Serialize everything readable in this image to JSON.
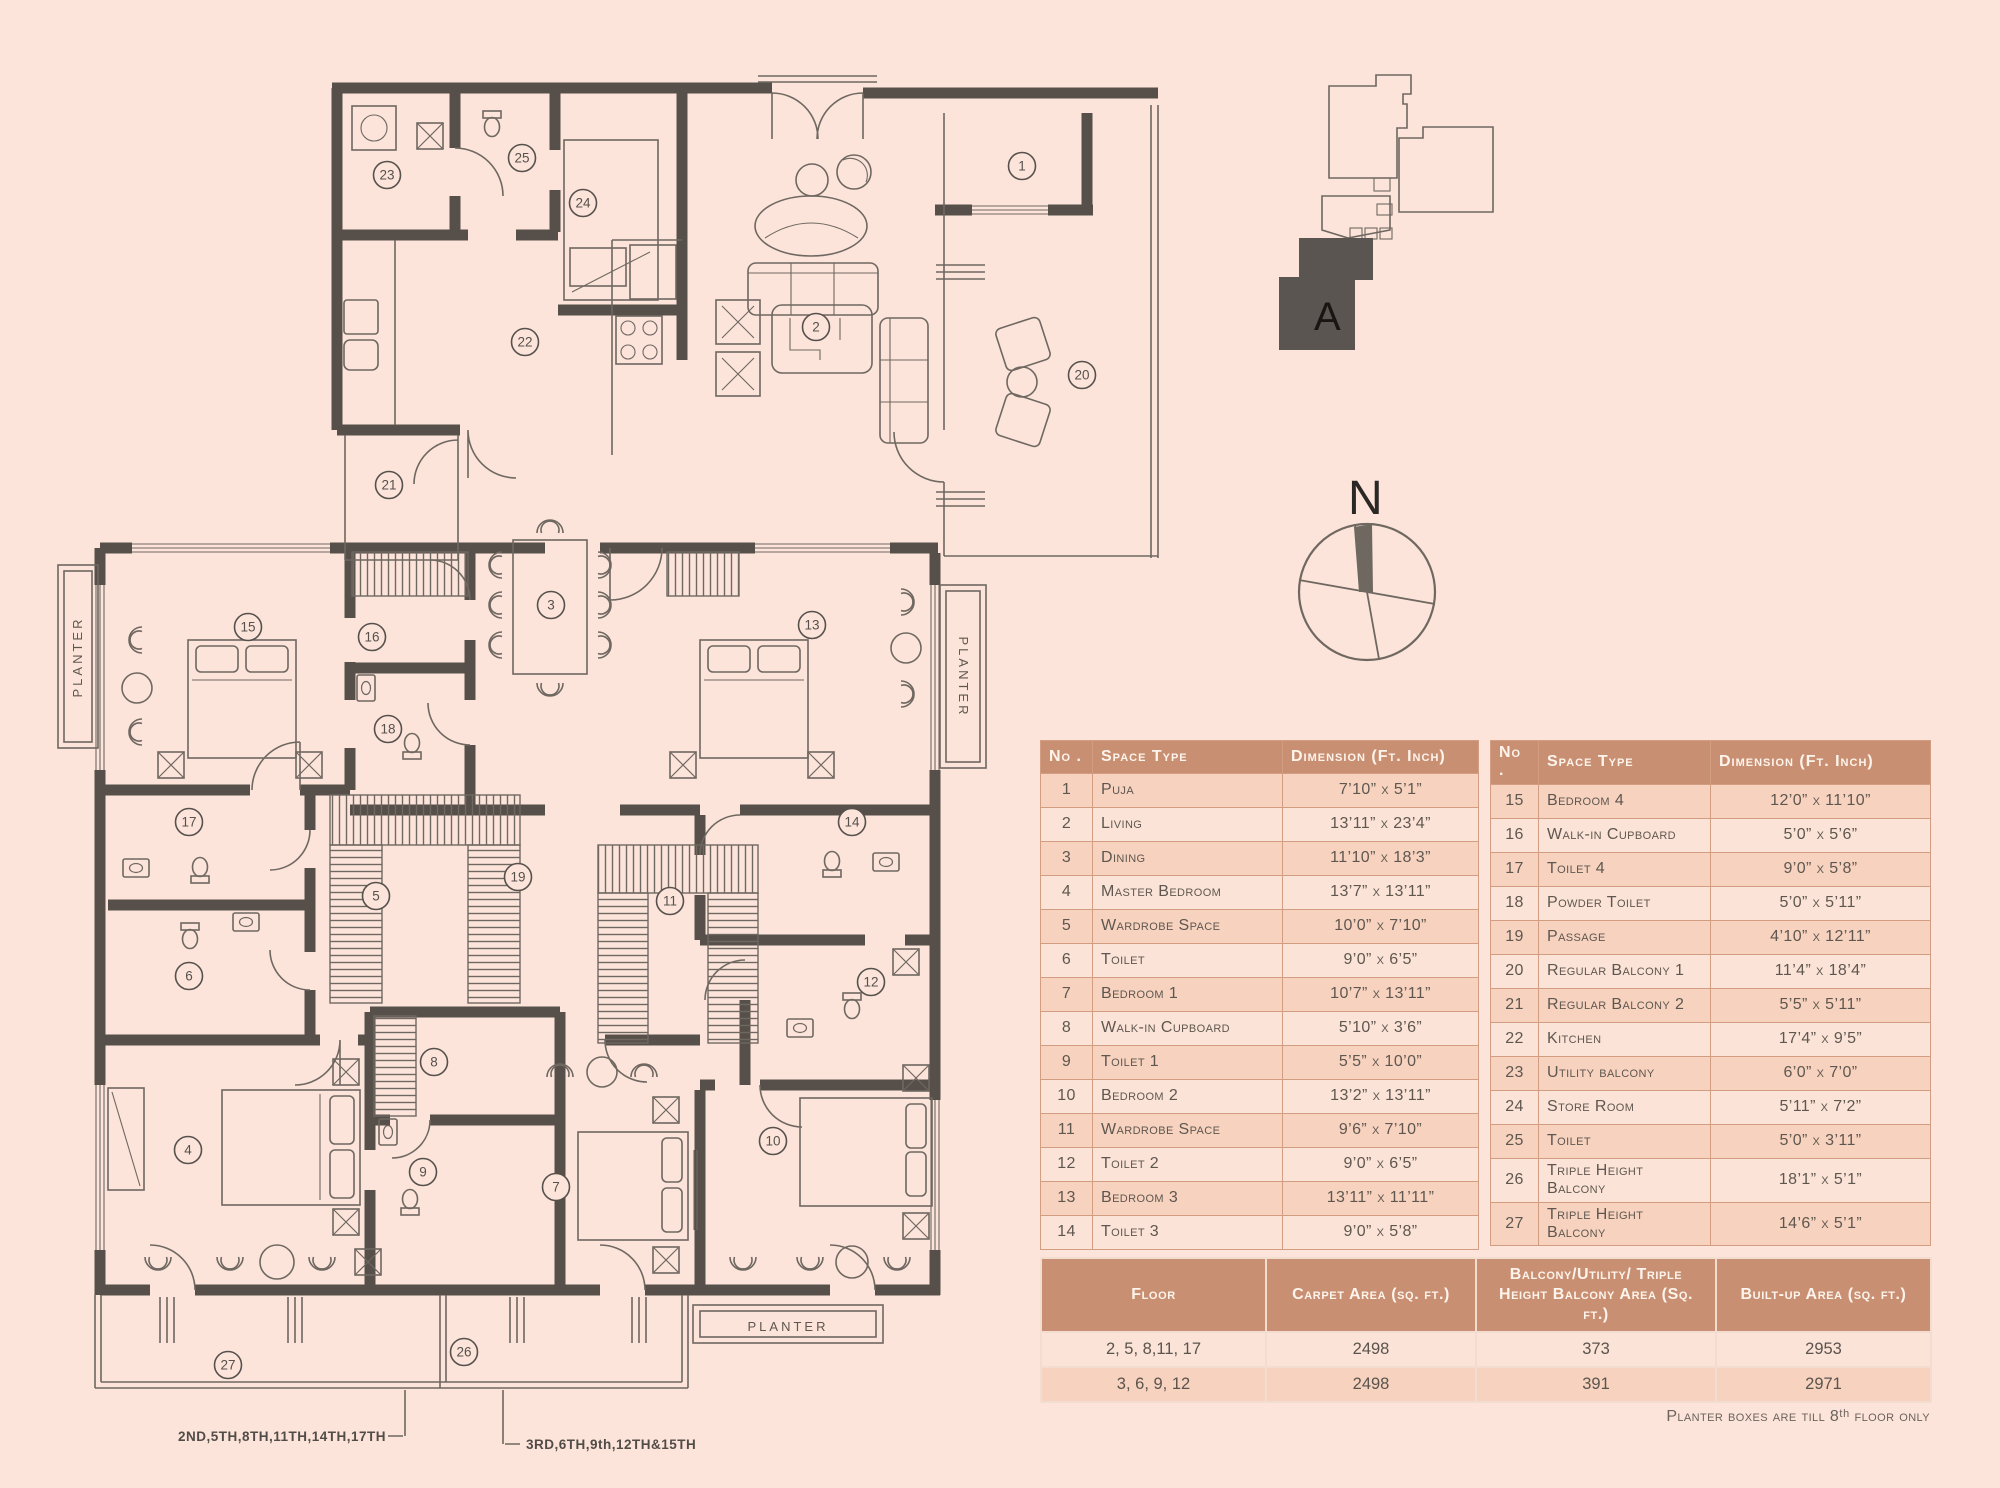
{
  "colors": {
    "background": "#fce4da",
    "wall": "#564f4a",
    "thin_line": "#6f6861",
    "table_header_bg": "#c98f72",
    "table_header_text": "#fdf4ec",
    "row_odd": "#f6d2bf",
    "row_even": "#fbe3d7",
    "table_border": "#d29d80"
  },
  "plan": {
    "planter_left": "PLANTER",
    "planter_right": "PLANTER",
    "planter_bottom": "PLANTER",
    "callout_left": "2ND,5TH,8TH,11TH,14TH,17TH",
    "callout_right": "3RD,6TH,9th,12TH&15TH",
    "markers": [
      {
        "n": "1",
        "x": 1022,
        "y": 166
      },
      {
        "n": "2",
        "x": 816,
        "y": 327
      },
      {
        "n": "3",
        "x": 551,
        "y": 605
      },
      {
        "n": "4",
        "x": 188,
        "y": 1150
      },
      {
        "n": "5",
        "x": 376,
        "y": 896
      },
      {
        "n": "6",
        "x": 189,
        "y": 976
      },
      {
        "n": "7",
        "x": 556,
        "y": 1187
      },
      {
        "n": "8",
        "x": 434,
        "y": 1062
      },
      {
        "n": "9",
        "x": 423,
        "y": 1172
      },
      {
        "n": "10",
        "x": 773,
        "y": 1141
      },
      {
        "n": "11",
        "x": 670,
        "y": 901
      },
      {
        "n": "12",
        "x": 871,
        "y": 982
      },
      {
        "n": "13",
        "x": 812,
        "y": 625
      },
      {
        "n": "14",
        "x": 852,
        "y": 822
      },
      {
        "n": "15",
        "x": 248,
        "y": 627
      },
      {
        "n": "16",
        "x": 372,
        "y": 637
      },
      {
        "n": "17",
        "x": 189,
        "y": 822
      },
      {
        "n": "18",
        "x": 388,
        "y": 729
      },
      {
        "n": "19",
        "x": 518,
        "y": 877
      },
      {
        "n": "20",
        "x": 1082,
        "y": 375
      },
      {
        "n": "21",
        "x": 389,
        "y": 485
      },
      {
        "n": "22",
        "x": 525,
        "y": 342
      },
      {
        "n": "23",
        "x": 387,
        "y": 175
      },
      {
        "n": "24",
        "x": 583,
        "y": 203
      },
      {
        "n": "25",
        "x": 522,
        "y": 158
      },
      {
        "n": "26",
        "x": 464,
        "y": 1352
      },
      {
        "n": "27",
        "x": 228,
        "y": 1365
      }
    ]
  },
  "keyplan": {
    "unit_label": "A"
  },
  "compass": {
    "north_label": "N"
  },
  "space_tables": {
    "headers": {
      "no": "No .",
      "space": "Space Type",
      "dimension": "Dimension (Ft. Inch)"
    },
    "left_rows": [
      [
        "1",
        "Puja",
        "7’10” x 5’1”"
      ],
      [
        "2",
        "Living",
        "13’11” x 23’4”"
      ],
      [
        "3",
        "Dining",
        "11’10” x 18’3”"
      ],
      [
        "4",
        "Master Bedroom",
        "13’7” x 13’11”"
      ],
      [
        "5",
        "Wardrobe Space",
        "10’0” x 7’10”"
      ],
      [
        "6",
        "Toilet",
        "9’0” x 6’5”"
      ],
      [
        "7",
        "Bedroom 1",
        "10’7” x 13’11”"
      ],
      [
        "8",
        "Walk-in Cupboard",
        "5’10” x 3’6”"
      ],
      [
        "9",
        "Toilet 1",
        "5’5” x 10’0”"
      ],
      [
        "10",
        "Bedroom 2",
        "13’2” x 13’11”"
      ],
      [
        "11",
        "Wardrobe Space",
        "9’6” x 7’10”"
      ],
      [
        "12",
        "Toilet 2",
        "9’0” x 6’5”"
      ],
      [
        "13",
        "Bedroom 3",
        "13’11” x 11’11”"
      ],
      [
        "14",
        "Toilet 3",
        "9’0” x 5’8”"
      ]
    ],
    "right_rows": [
      [
        "15",
        "Bedroom 4",
        "12’0” x 11’10”"
      ],
      [
        "16",
        "Walk-in Cupboard",
        "5’0” x 5’6”"
      ],
      [
        "17",
        "Toilet 4",
        "9’0” x 5’8”"
      ],
      [
        "18",
        "Powder Toilet",
        "5’0” x 5’11”"
      ],
      [
        "19",
        "Passage",
        "4’10” x 12’11”"
      ],
      [
        "20",
        "Regular Balcony 1",
        "11’4” x 18’4”"
      ],
      [
        "21",
        "Regular Balcony 2",
        "5’5” x 5’11”"
      ],
      [
        "22",
        "Kitchen",
        "17’4” x 9’5”"
      ],
      [
        "23",
        "Utility balcony",
        "6’0” x 7’0”"
      ],
      [
        "24",
        "Store Room",
        "5’11” x 7’2”"
      ],
      [
        "25",
        "Toilet",
        "5’0” x 3’11”"
      ],
      [
        "26",
        "Triple Height Balcony",
        "18’1” x 5’1”"
      ],
      [
        "27",
        "Triple Height Balcony",
        "14’6” x 5’1”"
      ]
    ]
  },
  "area_table": {
    "headers": [
      "Floor",
      "Carpet Area (sq. ft.)",
      "Balcony/Utility/ Triple Height Balcony Area (Sq. ft.)",
      "Built-up Area (sq. ft.)"
    ],
    "rows": [
      [
        "2, 5, 8,11, 17",
        "2498",
        "373",
        "2953"
      ],
      [
        "3, 6, 9, 12",
        "2498",
        "391",
        "2971"
      ]
    ]
  },
  "note": "Planter boxes are till 8ᵗʰ floor only"
}
